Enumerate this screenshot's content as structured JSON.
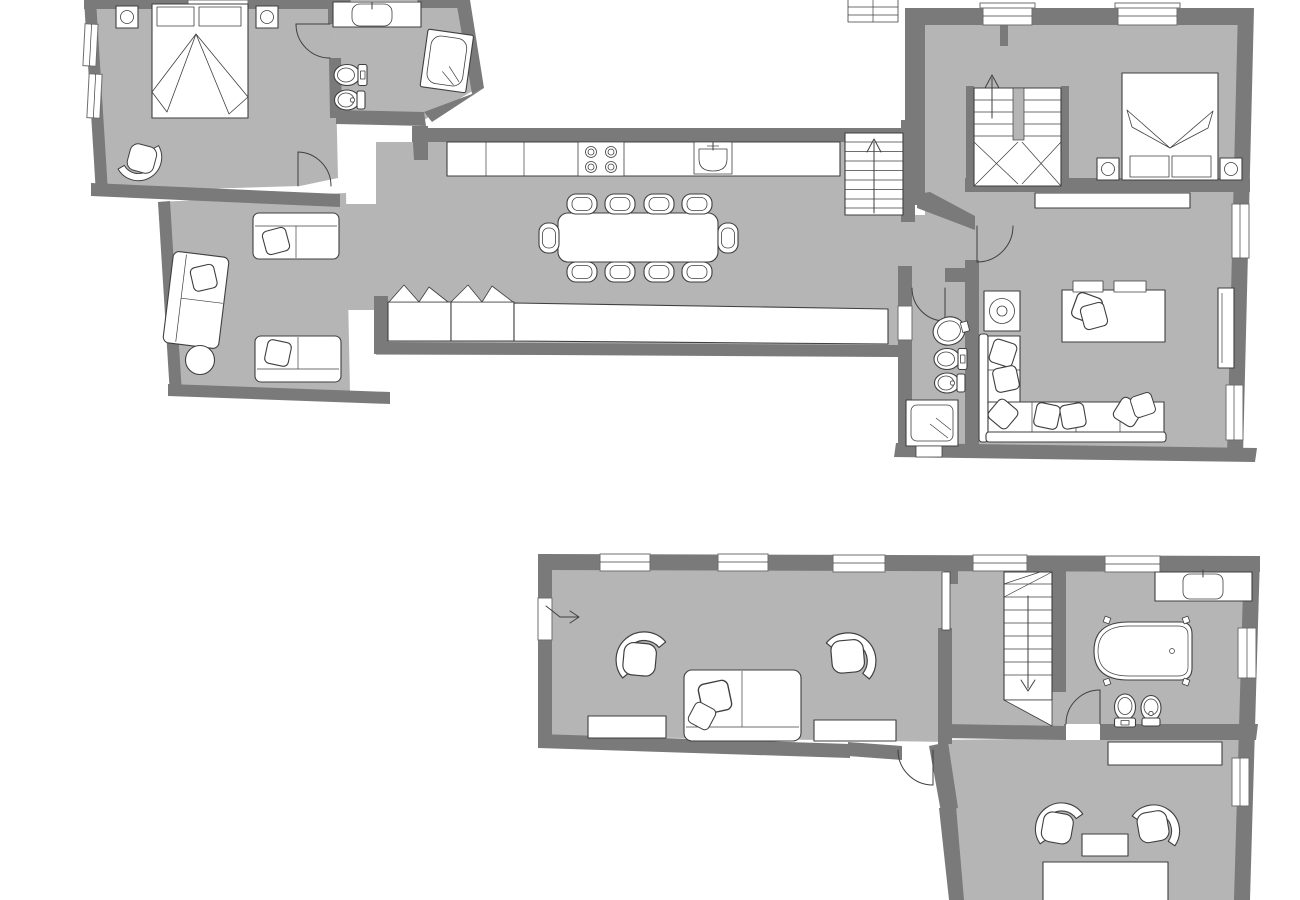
{
  "colors": {
    "background": "#ffffff",
    "floor": "#b5b5b5",
    "wall": "#7a7a7a",
    "line": "#3f3f3f",
    "fixture": "#ffffff"
  },
  "plans": {
    "upper": {
      "label": "upper-floor-plan",
      "rooms": {
        "bedroom_left": [
          "double-bed",
          "pillows",
          "nightstand-lamp",
          "nightstand-lamp",
          "armchair"
        ],
        "bathroom_left": [
          "vanity-sink",
          "toilet",
          "bidet",
          "shower-cabin"
        ],
        "living_left": [
          "sofa",
          "sofa",
          "chaise-sofa",
          "round-table"
        ],
        "kitchen_dining": [
          "kitchen-counter",
          "stove-4-burners",
          "kitchen-sink",
          "dining-table",
          "chairs-x10",
          "sideboard-cabinets",
          "stairs-up"
        ],
        "bedroom_right": [
          "switchback-stairs",
          "double-bed",
          "pillows",
          "nightstand-lamp",
          "nightstand-lamp",
          "wardrobe-shelf"
        ],
        "bathroom_right": [
          "wash-basin",
          "toilet",
          "bidet",
          "shower-cabin"
        ],
        "living_right": [
          "record-table",
          "desk",
          "desk-chair-cushions",
          "corner-sofa",
          "cushions",
          "tv-panel"
        ]
      }
    },
    "lower": {
      "label": "lower-floor-plan",
      "rooms": {
        "living": [
          "entrance-arrow",
          "armchair",
          "armchair",
          "sofa",
          "sideboard",
          "sideboard"
        ],
        "hall_stairs": [
          "stairs-down",
          "door-leaf"
        ],
        "bathroom": [
          "vanity-sink",
          "freestanding-bathtub",
          "toilet",
          "bidet"
        ],
        "bottom_room": [
          "sideboard",
          "armchair",
          "armchair",
          "side-table",
          "bed"
        ]
      }
    }
  }
}
